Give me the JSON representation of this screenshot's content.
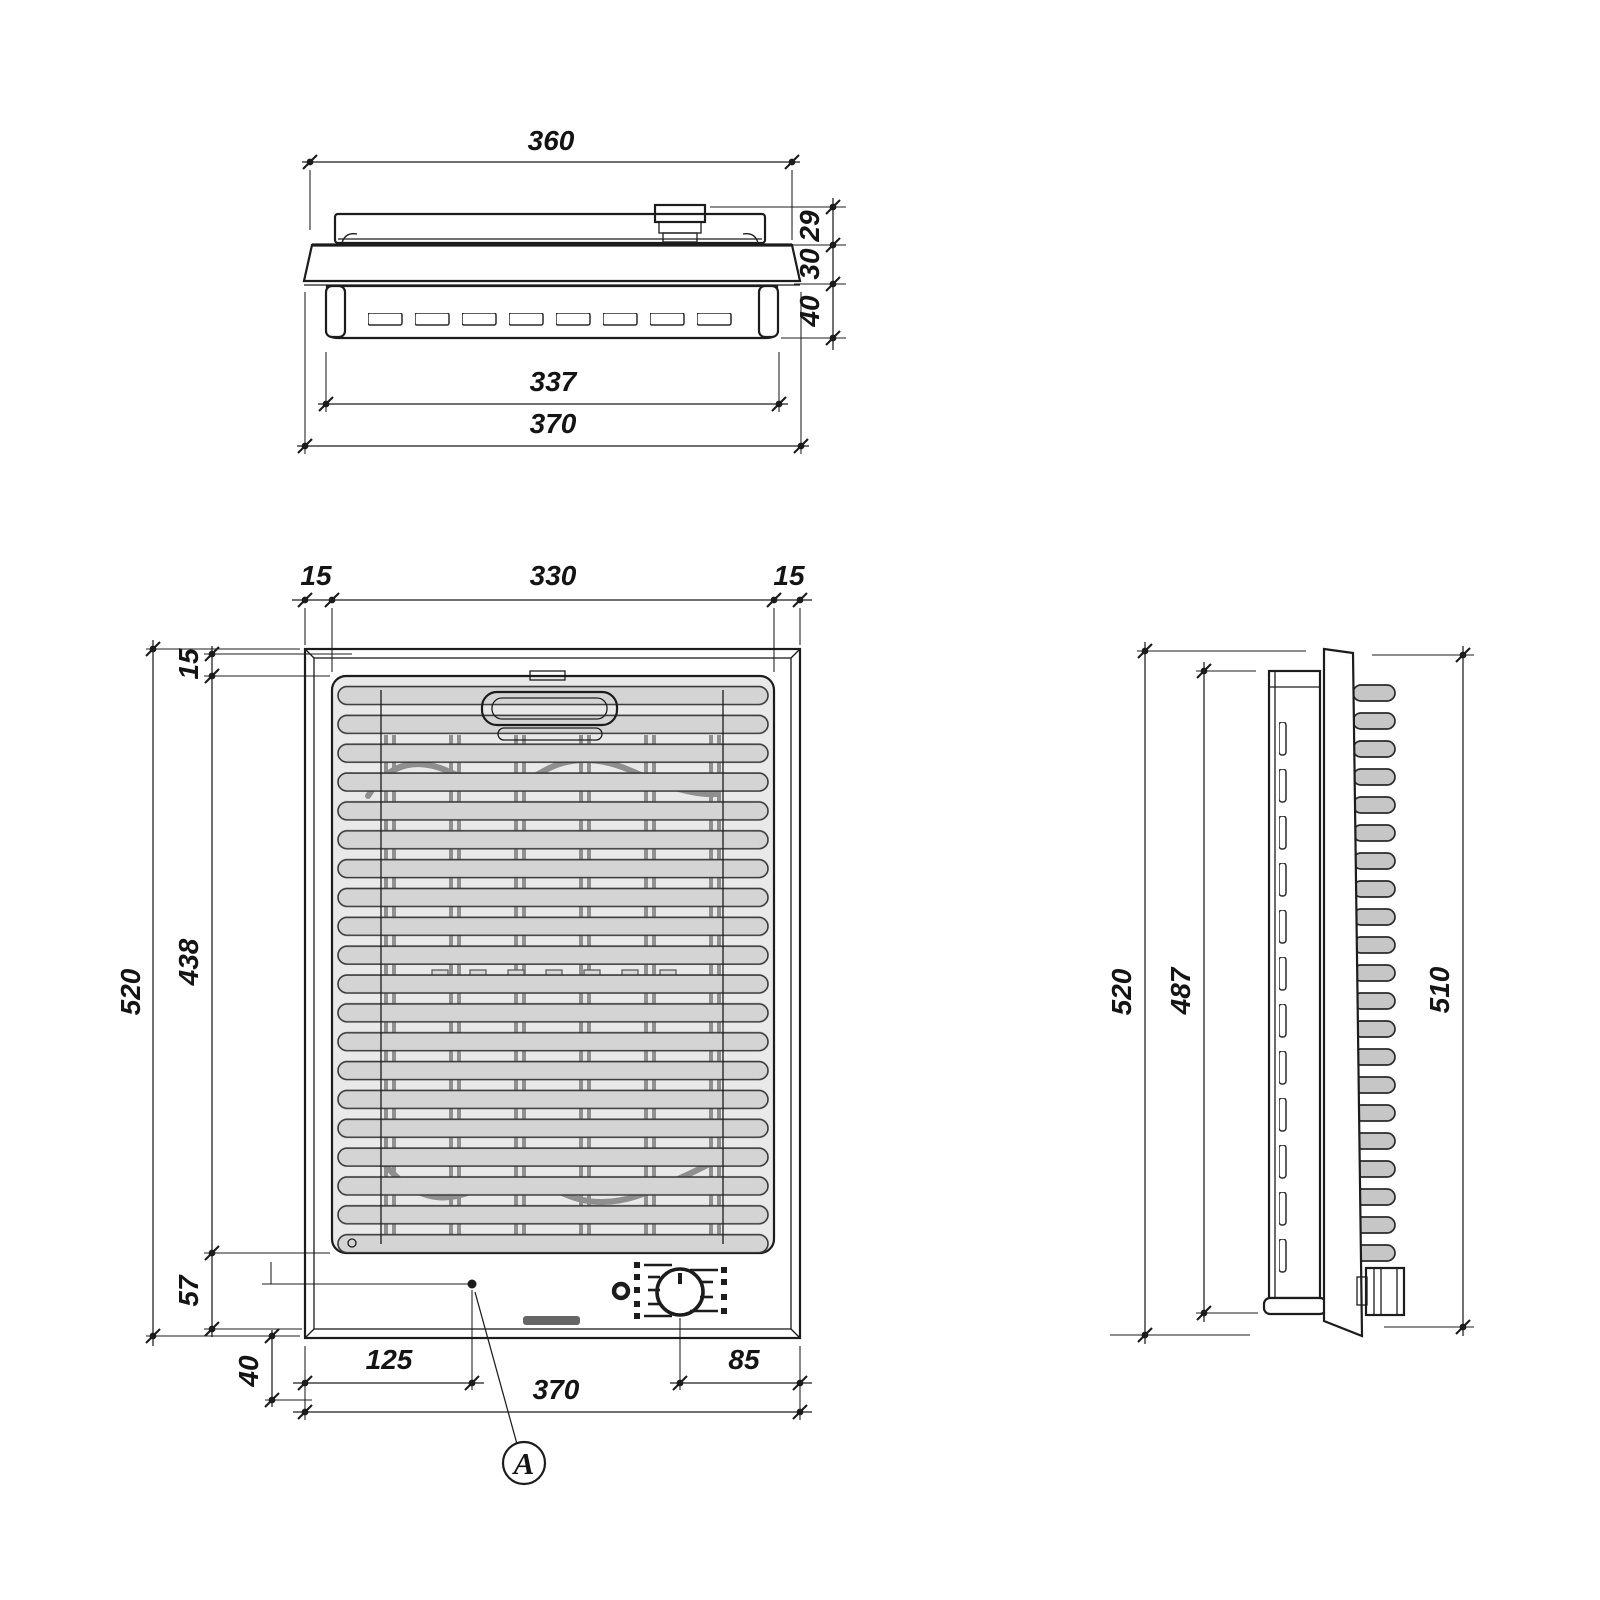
{
  "colors": {
    "line": "#1c1c1c",
    "metal_light": "#efefef",
    "metal_mid": "#c9c9c9",
    "metal_dark": "#8f8f8f",
    "background": "#ffffff"
  },
  "views": {
    "elevation": {
      "dims": {
        "grate_width": "360",
        "above_counter": "29",
        "trim_height": "30",
        "under_counter": "40",
        "inner_width": "337",
        "overall_width": "370"
      }
    },
    "front": {
      "dims": {
        "top_left_inset": "15",
        "grate_width": "330",
        "top_right_inset": "15",
        "side_top_inset": "15",
        "grate_height": "438",
        "overall_height": "520",
        "panel_height": "57",
        "under_depth": "40",
        "callout_offset": "125",
        "overall_width": "370",
        "knob_offset": "85"
      },
      "callout": {
        "label": "A"
      }
    },
    "side": {
      "dims": {
        "overall_height": "520",
        "body_height": "487",
        "grate_height": "510"
      }
    }
  }
}
